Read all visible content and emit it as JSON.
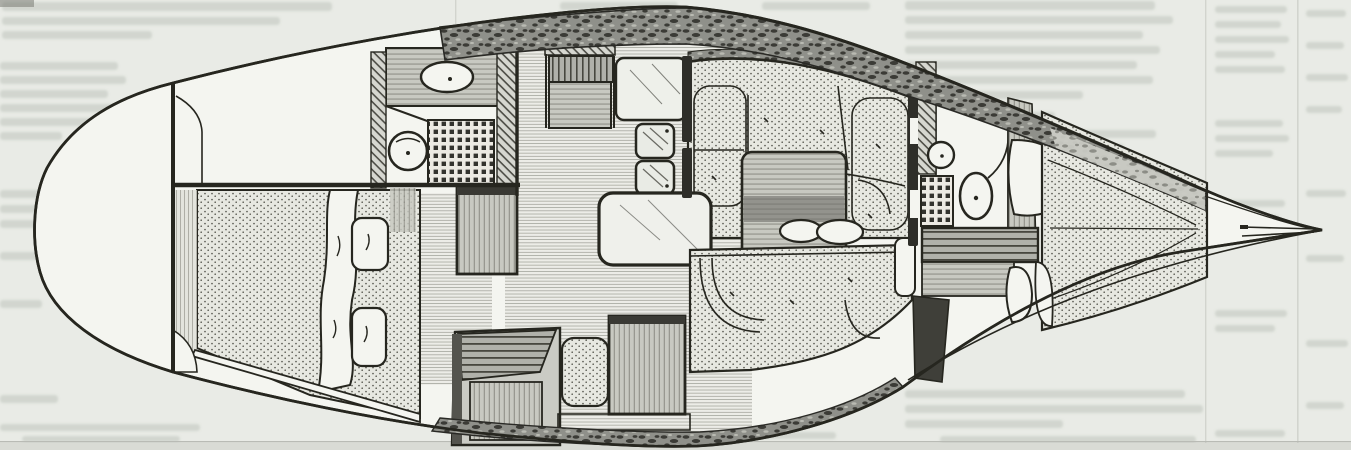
{
  "page": {
    "kind": "scanned magazine page",
    "description": "Black-and-white overhead accommodation-plan drawing of a sailing yacht interior, bow pointing right, printed on a light grey magazine page with faint show-through text from the reverse side",
    "legible_text": "",
    "artifacts": [
      "faint ghosted body text around the drawing",
      "thin column rules on the right side",
      "light scanner band along the bottom edge"
    ]
  },
  "colors": {
    "page_bg": "#e9ebe6",
    "paper_light": "#f4f5f0",
    "ink": "#26261f",
    "ghost_text": "#ced2cb",
    "stipple_dot": "#56564e",
    "deck_texture": "#3b3b36",
    "wood_grey": "#c8c9c1",
    "scan_band": "#d9dbd5"
  },
  "diagram": {
    "type": "boat-interior-plan",
    "orientation": "bow-right",
    "regions": [
      {
        "id": "stern-lazarette",
        "label": "rounded stern / lazarette"
      },
      {
        "id": "cockpit-well",
        "label": "cockpit well (empty white panel)"
      },
      {
        "id": "aft-cabin-berth",
        "label": "aft double berth with two pillows and turned-back blanket"
      },
      {
        "id": "aft-head",
        "label": "aft head: oval basin, round toilet, waffle shower grate"
      },
      {
        "id": "galley",
        "label": "galley: stove, worktop, twin sinks"
      },
      {
        "id": "companionway-steps",
        "label": "companionway step boxes"
      },
      {
        "id": "nav-cabinet",
        "label": "wood cabinet / nav locker"
      },
      {
        "id": "saloon-table",
        "label": "rounded saloon table"
      },
      {
        "id": "table-leaf",
        "label": "wood-grain table leaf with twin oval vents"
      },
      {
        "id": "dinette-settee",
        "label": "U-shaped dinette settee (stippled cushions)"
      },
      {
        "id": "lower-settee",
        "label": "opposite settee (stippled cushions)"
      },
      {
        "id": "forward-head",
        "label": "forward head: basin, toilet, shower grate"
      },
      {
        "id": "hanging-locker",
        "label": "hanging locker with curved door"
      },
      {
        "id": "v-berth",
        "label": "V-berth cushions tapering into the bow"
      },
      {
        "id": "bow-fitting",
        "label": "bow fitting / forestay lines"
      }
    ]
  }
}
